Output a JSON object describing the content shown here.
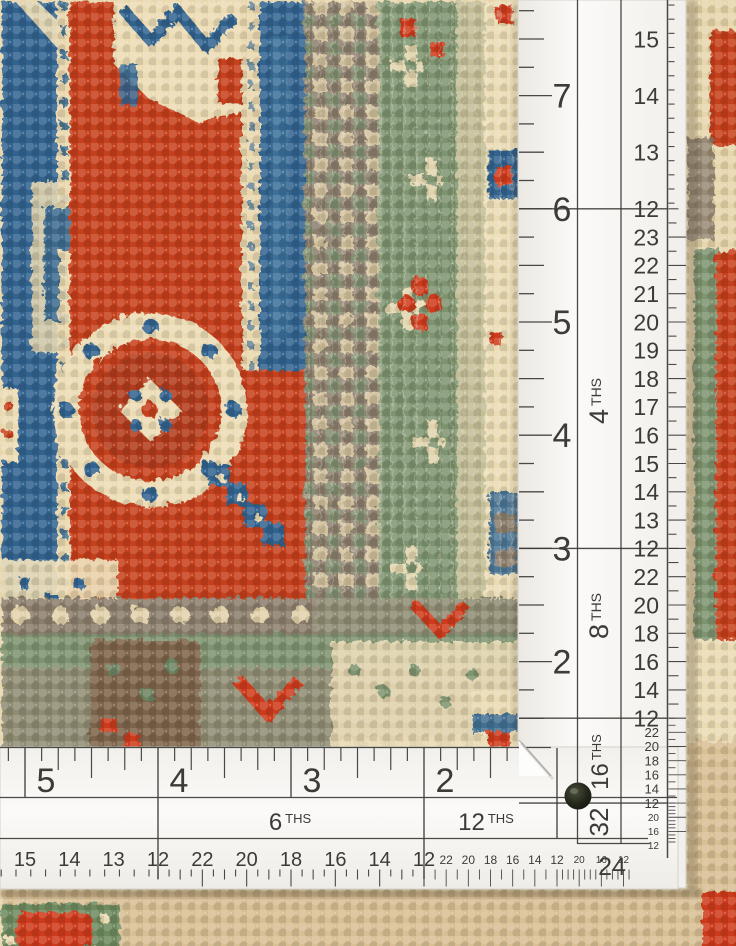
{
  "ruler": {
    "vertical": {
      "inch_numbers": [
        "7",
        "6",
        "5",
        "4",
        "3",
        "2"
      ],
      "bands": [
        {
          "label": "",
          "label_num": "",
          "label_suffix": "",
          "numbers": [
            "15",
            "14",
            "13",
            "12"
          ]
        },
        {
          "label": "4 THS",
          "label_num": "4",
          "label_suffix": "THS",
          "numbers": [
            "23",
            "22",
            "21",
            "20",
            "19",
            "18",
            "17",
            "16",
            "15",
            "14",
            "13",
            "12"
          ]
        },
        {
          "label": "8 THS",
          "label_num": "8",
          "label_suffix": "THS",
          "numbers": [
            "22",
            "20",
            "18",
            "16",
            "14",
            "12"
          ]
        },
        {
          "label": "16 THS",
          "label_num": "16",
          "label_suffix": "THS",
          "numbers": [
            "22",
            "20",
            "18",
            "16",
            "14",
            "12"
          ]
        },
        {
          "label": "32",
          "label_num": "32",
          "label_suffix": "",
          "numbers": [
            "20",
            "16",
            "12"
          ]
        }
      ]
    },
    "horizontal": {
      "inch_numbers": [
        "5",
        "4",
        "3",
        "2"
      ],
      "bands": [
        {
          "label": "",
          "label_num": "",
          "label_suffix": "",
          "numbers": [
            "15",
            "14",
            "13",
            "12"
          ]
        },
        {
          "label": "6 THS",
          "label_num": "6",
          "label_suffix": "THS",
          "numbers": [
            "22",
            "20",
            "18",
            "16",
            "14",
            "12"
          ]
        },
        {
          "label": "12 THS",
          "label_num": "12",
          "label_suffix": "THS",
          "numbers": [
            "22",
            "20",
            "18",
            "16",
            "14",
            "12"
          ]
        },
        {
          "label": "24",
          "label_num": "24",
          "label_suffix": "",
          "numbers": [
            "20",
            "16",
            "12"
          ]
        }
      ]
    }
  },
  "colors": {
    "ruler_white": "#f7f5f1",
    "ruler_mark": "#3c3b38",
    "rug_red": "#c5401f",
    "rug_red_bright": "#cd3b1c",
    "rug_blue": "#31648e",
    "rug_blue_dark": "#2a5a82",
    "rug_cream": "#e7d6ac",
    "rug_cream_light": "#eadbb3",
    "rug_tan": "#d8bf94",
    "rug_green": "#7e9470",
    "rug_taupe": "#8b7e6c",
    "rug_brown": "#7d6448"
  }
}
